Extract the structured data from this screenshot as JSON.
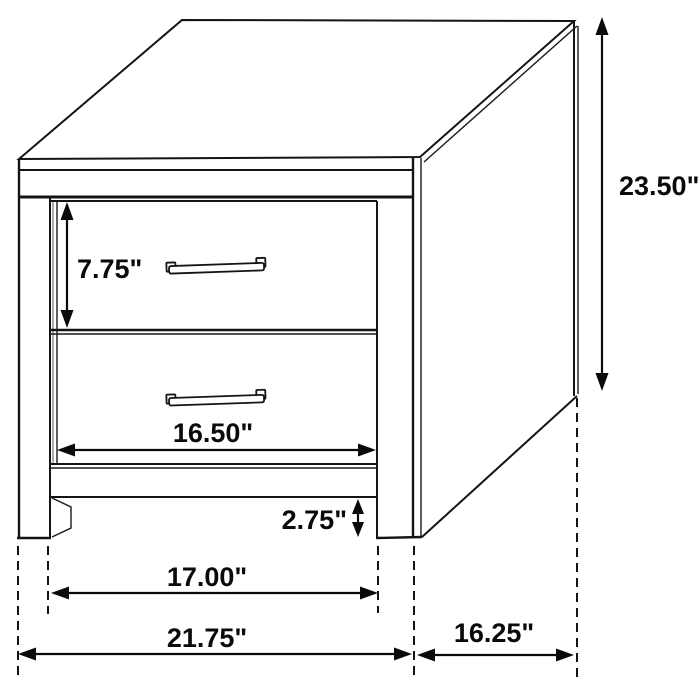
{
  "diagram": {
    "subject": "two-drawer nightstand dimension drawing",
    "background_color": "#ffffff",
    "line_color": "#141414",
    "dimensions": {
      "drawer_height": {
        "label": "7.75\""
      },
      "overall_height": {
        "label": "23.50\""
      },
      "drawer_width": {
        "label": "16.50\""
      },
      "base_clearance": {
        "label": "2.75\""
      },
      "leg_inner_span": {
        "label": "17.00\""
      },
      "overall_width": {
        "label": "21.75\""
      },
      "overall_depth": {
        "label": "16.25\""
      }
    }
  }
}
